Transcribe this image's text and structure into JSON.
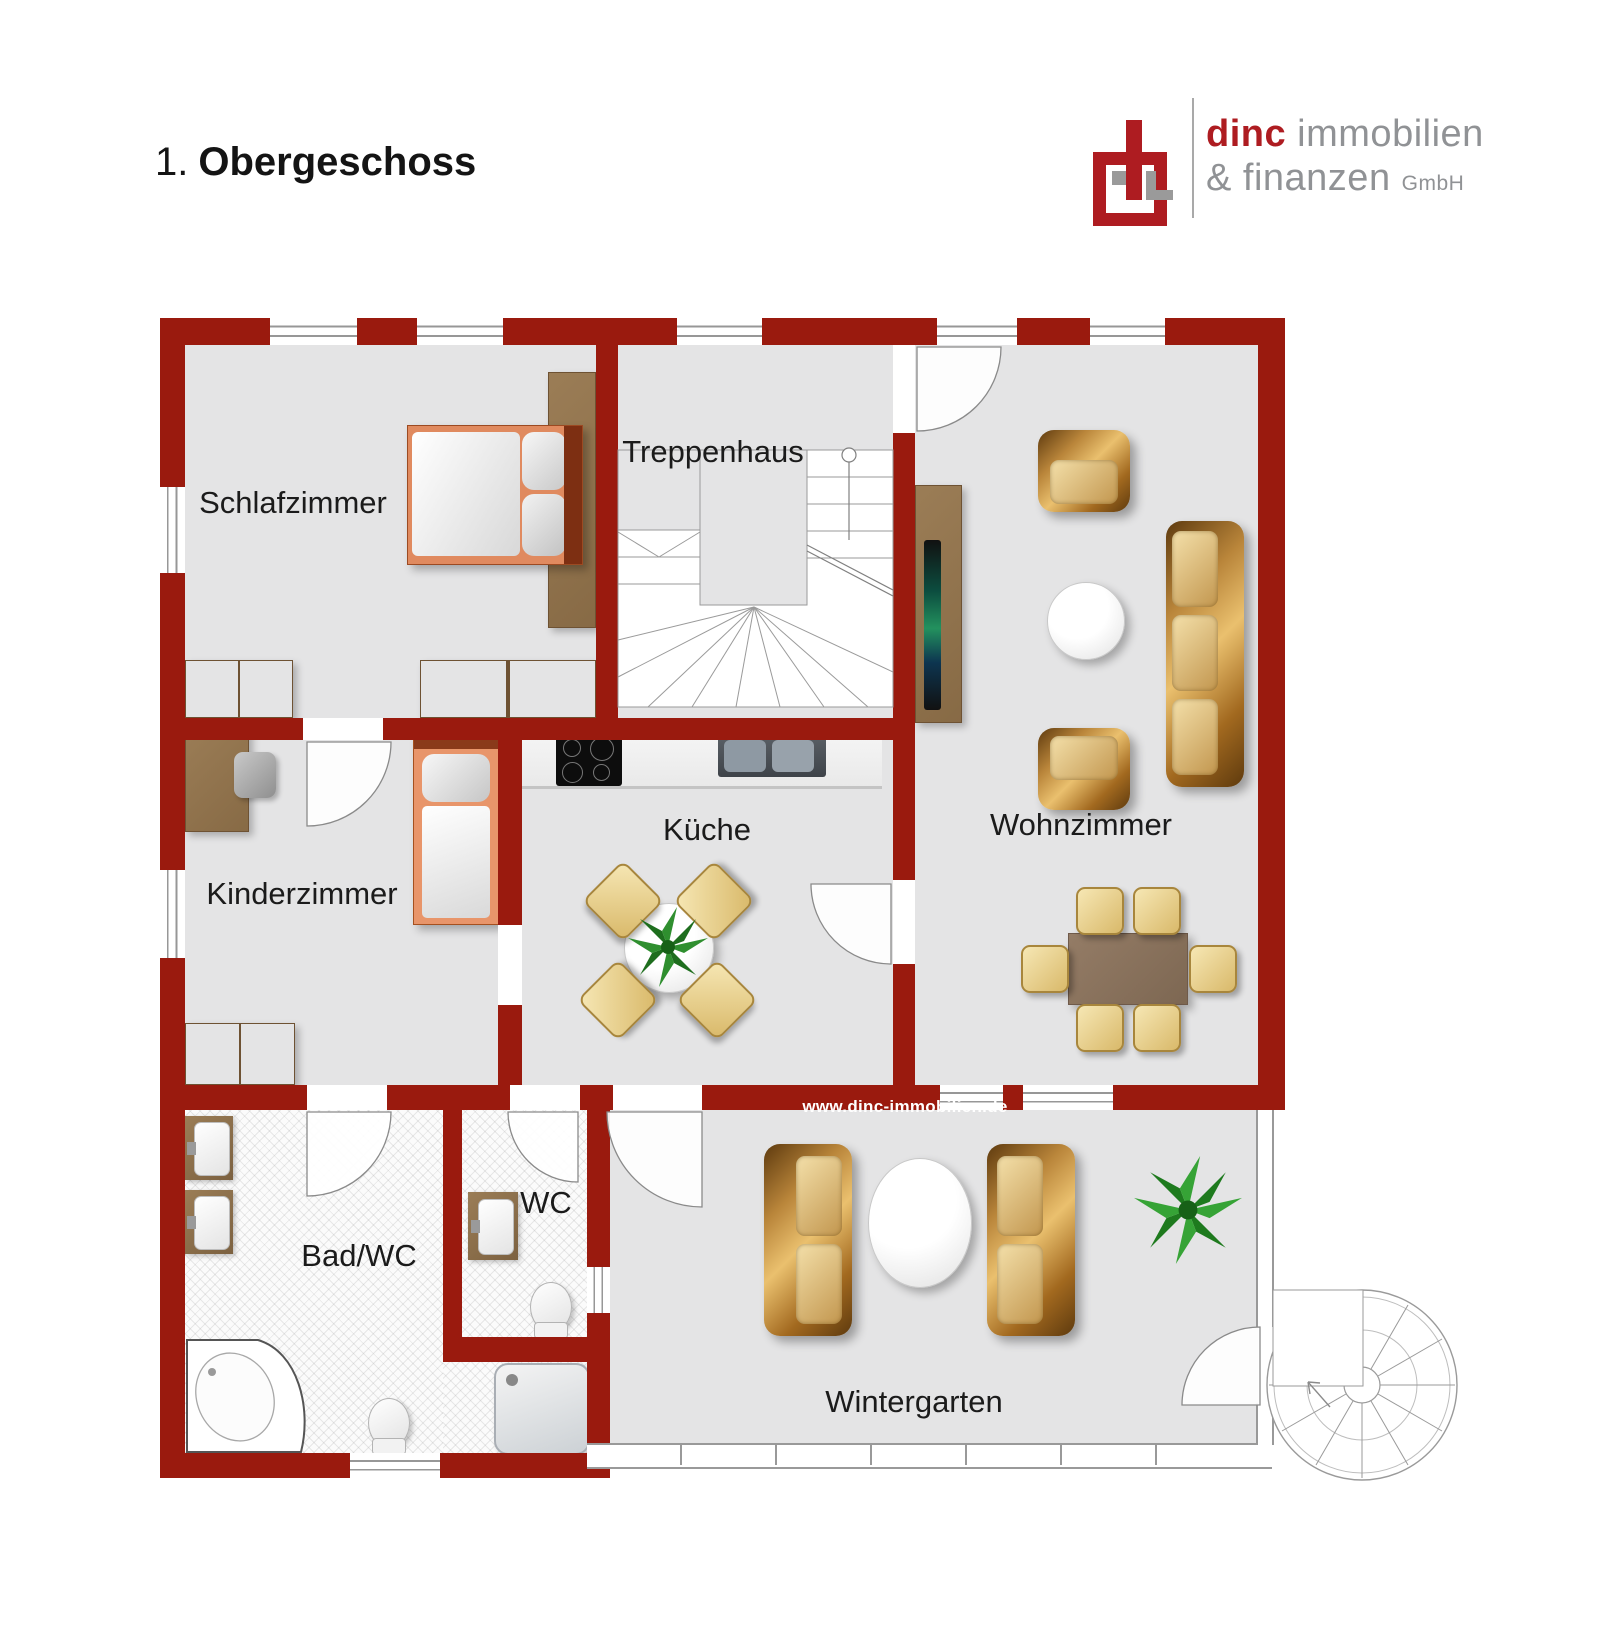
{
  "header": {
    "floor_prefix": "1.",
    "title": "Obergeschoss"
  },
  "logo": {
    "brand": "dinc",
    "brand_rest": " immobilien",
    "line2": "& finanzen ",
    "suffix": "GmbH"
  },
  "watermark": "www.dinc-immobilien.de",
  "rooms": {
    "schlafzimmer": "Schlafzimmer",
    "treppenhaus": "Treppenhaus",
    "wohnzimmer": "Wohnzimmer",
    "kinderzimmer": "Kinderzimmer",
    "kueche": "Küche",
    "bad": "Bad/WC",
    "wc": "WC",
    "wintergarten": "Wintergarten"
  },
  "colors": {
    "wall": "#9a1a0e",
    "floor": "#e4e4e5",
    "logo-red": "#ae1c21",
    "logo-gray": "#909295"
  }
}
